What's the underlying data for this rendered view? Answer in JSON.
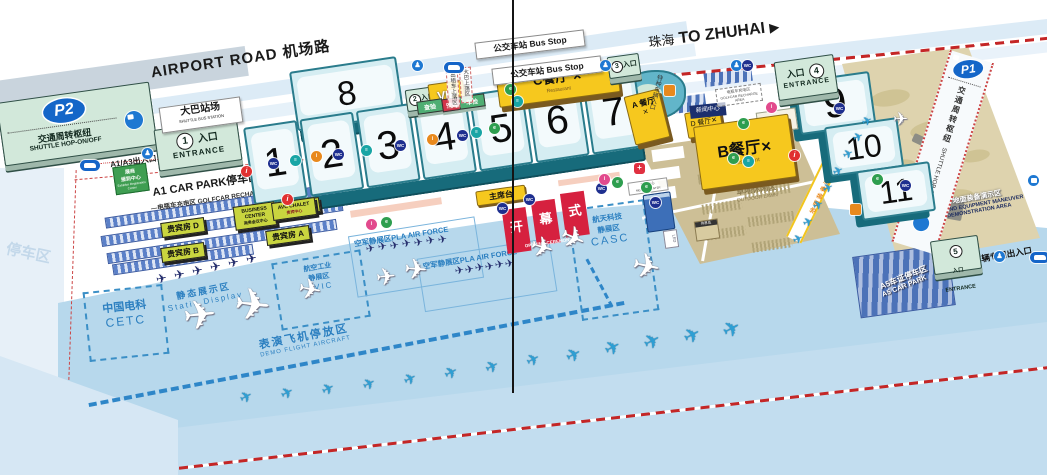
{
  "roads": {
    "airport_road": "AIRPORT ROAD 机场路",
    "to_zhuhai_cn": "珠海",
    "to_zhuhai_en": "TO ZHUHAI",
    "to_zhuhai_arrow": "▶",
    "bus_stop": "公交车站 Bus Stop",
    "a1a3_gate": "A1/A3出入口",
    "a5_gate_road": "A5车辆专用出入口",
    "special_vehicle_gate": "特种车辆入口"
  },
  "parking": {
    "p2": "P2",
    "p1": "P1",
    "shuttle_cn": "交通周转枢纽",
    "shuttle_en": "SHUTTLE HOP-ON/OFF",
    "bus_terminal": "大巴站场",
    "bus_terminal_en": "SHUTTLE BUS STATION",
    "a1_car_park": "A1 CAR PARK停车区",
    "golfcar_recharge": "—电瓶车充电区 GOLFCAR RECHARGE AREA—",
    "golfcar_recharge2_cn": "电瓶车充电区",
    "golfcar_recharge2_en": "GOLFCAR RECHARGE AREA",
    "a5_car_park_cn": "A5车证停车区",
    "a5_car_park_en": "A5 CAR PARK",
    "watermark": "停车区"
  },
  "entrances": [
    {
      "num": "1",
      "cn": "入口",
      "en": "ENTRANCE"
    },
    {
      "num": "2",
      "cn": "入口",
      "en": ""
    },
    {
      "num": "3",
      "cn": "入口",
      "en": ""
    },
    {
      "num": "4",
      "cn": "入口",
      "en": "ENTRANCE"
    },
    {
      "num": "5",
      "cn": "入口",
      "en": "ENTRANCE"
    }
  ],
  "halls": [
    "1",
    "2",
    "3",
    "4",
    "5",
    "6",
    "7",
    "8",
    "9",
    "10",
    "11"
  ],
  "buildings": {
    "er1": "展商",
    "er2": "报到中心",
    "er3": "Exhibitor Registration Center",
    "chalets": [
      "贵宾房 C",
      "贵宾房 D",
      "贵宾房 A",
      "贵宾房 B"
    ],
    "business_center_en": "BUSINESS CENTER",
    "business_center_cn": "商务会议中心",
    "avc_chalet_en": "AVC CHALET",
    "avc_chalet_cn": "贵宾中心",
    "press_center": "新闻中心",
    "medical_cn": "医疗中心",
    "medical_en": "MEDICAL CENTER",
    "led": "LED",
    "rest_hut": "休息处"
  },
  "restaurants": {
    "icon": "✕",
    "a": "A 餐厅",
    "b": "B餐厅",
    "c": "C餐厅",
    "d": "D 餐厅",
    "sub_en": "Restaurant"
  },
  "vip": "VIP",
  "ceremony": {
    "rostrum": "主席台",
    "opening_chars": [
      "开",
      "幕",
      "式"
    ],
    "opening_en": "OPENING CEREMONY"
  },
  "checks": {
    "left": "查验",
    "mid": "安检",
    "right": "车检",
    "taxi": "出租车上落区",
    "bus_drop": "大巴上落区"
  },
  "lawn": {
    "cn": "草地休闲区",
    "en": "OUTDOOR LAWN"
  },
  "corridor": {
    "text": "地面装备演示区",
    "arrow": "▶"
  },
  "ground_equipment": {
    "cn": "地面装备演示区",
    "en1": "GROUND EQUIPMENT MANEUVER",
    "en2": "DEMONSTRATION AREA"
  },
  "display_zones": {
    "static_cn": "静态展示区",
    "static_en": "Static Display",
    "cetc_cn": "中国电科",
    "cetc_en": "CETC",
    "avic_cn1": "航空工业",
    "avic_cn2": "静展区",
    "avic_en": "AVIC",
    "pla": "空军静展区PLA AIR FORCE",
    "casc_cn": "航天科技静展区",
    "casc_en": "CASC",
    "demo_cn": "表演飞机停放区",
    "demo_en": "DEMO FLIGHT AIRCRAFT"
  },
  "colors": {
    "hall_top": "#d5edf2",
    "hall_side": "#176b7b",
    "hall_border": "#2a7c8c",
    "green_building": "#d2e8da",
    "yellow_building": "#f6c81e",
    "apron_blue": "#b7d8ec",
    "lawn_tan": "#cdbf96",
    "camo_tan": "#ded3ae",
    "accent_blue": "#1565c8",
    "zone_blue": "#2b7fc0",
    "red": "#d6213f",
    "chalet_green": "#c9d53f",
    "wc_navy": "#1e2f8f"
  },
  "icon_glyphs": {
    "wc": "WC",
    "teal": "≡",
    "orange": "i",
    "green": "e",
    "pink": "i",
    "info": "i",
    "medical": "+",
    "ped": "♟",
    "car": "",
    "bus": "",
    "sq": "",
    "plane": "✈"
  },
  "sprites": {
    "icons": [
      {
        "t": "ped",
        "x": 142,
        "y": 148
      },
      {
        "t": "car",
        "x": 80,
        "y": 160
      },
      {
        "t": "info",
        "x": 241,
        "y": 166
      },
      {
        "t": "info",
        "x": 282,
        "y": 194
      },
      {
        "t": "wc",
        "x": 268,
        "y": 158
      },
      {
        "t": "teal",
        "x": 290,
        "y": 155
      },
      {
        "t": "orange",
        "x": 311,
        "y": 151
      },
      {
        "t": "wc",
        "x": 333,
        "y": 149
      },
      {
        "t": "teal",
        "x": 361,
        "y": 145
      },
      {
        "t": "wc",
        "x": 395,
        "y": 140
      },
      {
        "t": "orange",
        "x": 427,
        "y": 134
      },
      {
        "t": "wc",
        "x": 457,
        "y": 130
      },
      {
        "t": "teal",
        "x": 471,
        "y": 127
      },
      {
        "t": "green",
        "x": 489,
        "y": 123
      },
      {
        "t": "ped",
        "x": 412,
        "y": 60
      },
      {
        "t": "car",
        "x": 444,
        "y": 62
      },
      {
        "t": "green",
        "x": 505,
        "y": 84
      },
      {
        "t": "teal",
        "x": 512,
        "y": 96
      },
      {
        "t": "wc",
        "x": 497,
        "y": 203
      },
      {
        "t": "wc",
        "x": 524,
        "y": 194
      },
      {
        "t": "pink",
        "x": 366,
        "y": 219
      },
      {
        "t": "green",
        "x": 381,
        "y": 217
      },
      {
        "t": "wc",
        "x": 596,
        "y": 183
      },
      {
        "t": "ped",
        "x": 600,
        "y": 60
      },
      {
        "t": "pink",
        "x": 599,
        "y": 174
      },
      {
        "t": "green",
        "x": 612,
        "y": 177
      },
      {
        "t": "medical",
        "x": 634,
        "y": 163
      },
      {
        "t": "green",
        "x": 641,
        "y": 182
      },
      {
        "t": "sq",
        "x": 664,
        "y": 85
      },
      {
        "t": "green",
        "x": 738,
        "y": 118
      },
      {
        "t": "green",
        "x": 728,
        "y": 153
      },
      {
        "t": "teal",
        "x": 743,
        "y": 156
      },
      {
        "t": "pink",
        "x": 766,
        "y": 102
      },
      {
        "t": "ped",
        "x": 731,
        "y": 60
      },
      {
        "t": "wc",
        "x": 742,
        "y": 60
      },
      {
        "t": "wc",
        "x": 834,
        "y": 103
      },
      {
        "t": "info",
        "x": 789,
        "y": 150
      },
      {
        "t": "green",
        "x": 872,
        "y": 174
      },
      {
        "t": "wc",
        "x": 900,
        "y": 180
      },
      {
        "t": "sq",
        "x": 850,
        "y": 204
      },
      {
        "t": "wc",
        "x": 650,
        "y": 197
      },
      {
        "t": "ped",
        "x": 994,
        "y": 251
      },
      {
        "t": "car",
        "x": 1030,
        "y": 252
      },
      {
        "t": "bus",
        "x": 1028,
        "y": 175
      }
    ],
    "planes": [
      {
        "c": "white",
        "x": 183,
        "y": 296,
        "s": 40,
        "r": -6
      },
      {
        "c": "white",
        "x": 234,
        "y": 284,
        "s": 44,
        "r": 6
      },
      {
        "c": "white",
        "x": 298,
        "y": 276,
        "s": 28,
        "r": 10
      },
      {
        "c": "white",
        "x": 376,
        "y": 266,
        "s": 24,
        "r": -6
      },
      {
        "c": "white",
        "x": 404,
        "y": 256,
        "s": 28,
        "r": 4
      },
      {
        "c": "white",
        "x": 530,
        "y": 234,
        "s": 28,
        "r": 16
      },
      {
        "c": "white",
        "x": 560,
        "y": 224,
        "s": 30,
        "r": 24
      },
      {
        "c": "white",
        "x": 632,
        "y": 250,
        "s": 34,
        "r": 12
      },
      {
        "c": "white",
        "x": 893,
        "y": 110,
        "s": 18,
        "r": 0
      },
      {
        "c": "navy",
        "x": 156,
        "y": 272,
        "s": 13,
        "r": -12
      },
      {
        "c": "navy",
        "x": 174,
        "y": 268,
        "s": 13,
        "r": -12
      },
      {
        "c": "navy",
        "x": 192,
        "y": 264,
        "s": 13,
        "r": -12
      },
      {
        "c": "navy",
        "x": 210,
        "y": 260,
        "s": 13,
        "r": -12
      },
      {
        "c": "navy",
        "x": 228,
        "y": 256,
        "s": 13,
        "r": -12
      },
      {
        "c": "navy",
        "x": 246,
        "y": 252,
        "s": 13,
        "r": -12
      },
      {
        "c": "navy",
        "x": 366,
        "y": 244,
        "s": 11,
        "r": -10
      },
      {
        "c": "navy",
        "x": 378,
        "y": 242,
        "s": 11,
        "r": -10
      },
      {
        "c": "navy",
        "x": 390,
        "y": 241,
        "s": 11,
        "r": -10
      },
      {
        "c": "navy",
        "x": 402,
        "y": 239,
        "s": 11,
        "r": -10
      },
      {
        "c": "navy",
        "x": 414,
        "y": 238,
        "s": 11,
        "r": -10
      },
      {
        "c": "navy",
        "x": 426,
        "y": 236,
        "s": 11,
        "r": -10
      },
      {
        "c": "navy",
        "x": 438,
        "y": 235,
        "s": 11,
        "r": -10
      },
      {
        "c": "navy",
        "x": 455,
        "y": 266,
        "s": 11,
        "r": -10
      },
      {
        "c": "navy",
        "x": 465,
        "y": 265,
        "s": 11,
        "r": -10
      },
      {
        "c": "navy",
        "x": 475,
        "y": 263,
        "s": 11,
        "r": -10
      },
      {
        "c": "navy",
        "x": 485,
        "y": 262,
        "s": 11,
        "r": -10
      },
      {
        "c": "navy",
        "x": 495,
        "y": 260,
        "s": 11,
        "r": -10
      },
      {
        "c": "navy",
        "x": 505,
        "y": 259,
        "s": 11,
        "r": -10
      },
      {
        "c": "blue",
        "x": 793,
        "y": 233,
        "s": 12,
        "r": -24
      },
      {
        "c": "blue",
        "x": 803,
        "y": 216,
        "s": 12,
        "r": -24
      },
      {
        "c": "blue",
        "x": 813,
        "y": 199,
        "s": 12,
        "r": -24
      },
      {
        "c": "blue",
        "x": 823,
        "y": 182,
        "s": 12,
        "r": -24
      },
      {
        "c": "blue",
        "x": 833,
        "y": 165,
        "s": 12,
        "r": -24
      },
      {
        "c": "blue",
        "x": 843,
        "y": 148,
        "s": 12,
        "r": -24
      },
      {
        "c": "blue",
        "x": 853,
        "y": 131,
        "s": 12,
        "r": -24
      },
      {
        "c": "blue",
        "x": 862,
        "y": 115,
        "s": 12,
        "r": -24
      }
    ],
    "jets": [
      {
        "x": 240,
        "y": 390,
        "s": 15
      },
      {
        "x": 281,
        "y": 386,
        "s": 15
      },
      {
        "x": 322,
        "y": 382,
        "s": 15
      },
      {
        "x": 363,
        "y": 377,
        "s": 15
      },
      {
        "x": 404,
        "y": 372,
        "s": 15
      },
      {
        "x": 445,
        "y": 366,
        "s": 16
      },
      {
        "x": 486,
        "y": 360,
        "s": 16
      },
      {
        "x": 527,
        "y": 353,
        "s": 16
      },
      {
        "x": 566,
        "y": 346,
        "s": 18
      },
      {
        "x": 605,
        "y": 339,
        "s": 19
      },
      {
        "x": 644,
        "y": 332,
        "s": 20
      },
      {
        "x": 684,
        "y": 326,
        "s": 20
      },
      {
        "x": 723,
        "y": 319,
        "s": 21
      }
    ],
    "lawn_patches": [
      {
        "x": 700,
        "y": 150,
        "w": 38
      },
      {
        "x": 742,
        "y": 158,
        "w": 44
      },
      {
        "x": 698,
        "y": 172,
        "w": 38
      },
      {
        "x": 744,
        "y": 186,
        "w": 46
      },
      {
        "x": 702,
        "y": 202,
        "w": 40
      },
      {
        "x": 748,
        "y": 214,
        "w": 46
      },
      {
        "x": 706,
        "y": 228,
        "w": 40
      },
      {
        "x": 752,
        "y": 240,
        "w": 40
      }
    ],
    "camo_blobs": [
      {
        "x": 870,
        "y": 90,
        "w": 40,
        "h": 16
      },
      {
        "x": 910,
        "y": 120,
        "w": 50,
        "h": 18
      },
      {
        "x": 880,
        "y": 160,
        "w": 36,
        "h": 14
      },
      {
        "x": 930,
        "y": 190,
        "w": 44,
        "h": 16
      },
      {
        "x": 960,
        "y": 150,
        "w": 30,
        "h": 12
      },
      {
        "x": 900,
        "y": 215,
        "w": 40,
        "h": 14
      }
    ],
    "equipment": [
      {
        "x": 912,
        "y": 138,
        "w": 26,
        "h": 9,
        "r": 25
      },
      {
        "x": 936,
        "y": 160,
        "w": 22,
        "h": 12,
        "r": 8
      },
      {
        "x": 902,
        "y": 175,
        "w": 7,
        "h": 26,
        "r": 18
      },
      {
        "x": 948,
        "y": 198,
        "w": 15,
        "h": 22,
        "r": 10
      },
      {
        "x": 928,
        "y": 208,
        "w": 13,
        "h": 13,
        "r": 0
      }
    ],
    "parking_bars": [
      {
        "x": 104,
        "y": 200,
        "w": 238
      },
      {
        "x": 100,
        "y": 218,
        "w": 242
      },
      {
        "x": 106,
        "y": 236,
        "w": 230
      },
      {
        "x": 112,
        "y": 254,
        "w": 140
      }
    ]
  }
}
